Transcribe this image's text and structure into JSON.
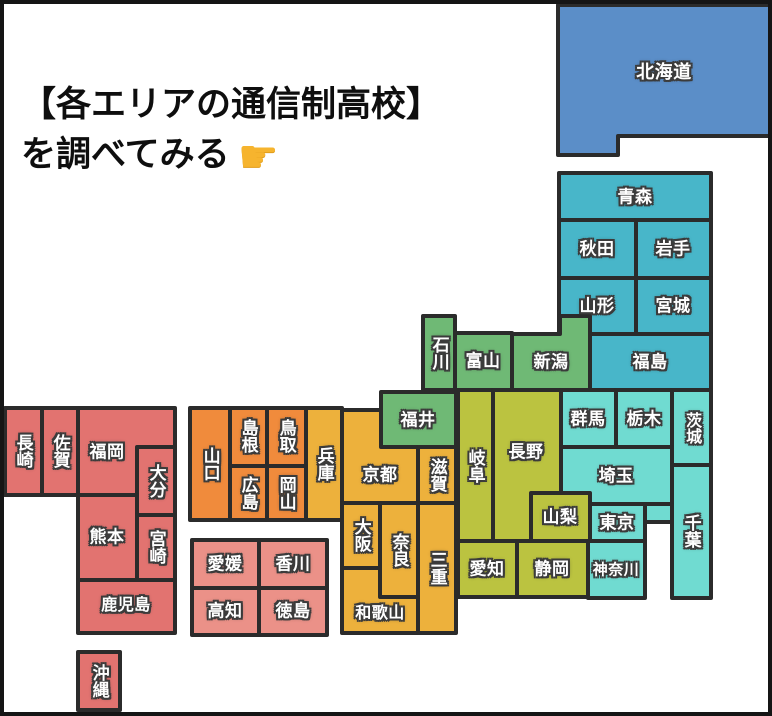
{
  "title": {
    "line1": "【各エリアの通信制高校】",
    "line2": "を調べてみる",
    "pointer_icon": {
      "name": "backhand-index-pointing-right",
      "glyph": "☛",
      "color": "#f6b42e"
    }
  },
  "map": {
    "border_color": "#2b2b2b",
    "region_colors": {
      "hokkaido": "#5b8ec8",
      "tohoku": "#48b6c9",
      "hokuriku": "#6fb975",
      "kanto": "#70dbd1",
      "chubu": "#bbc340",
      "kansai": "#edb13c",
      "chugoku": "#f08b3c",
      "shikoku": "#eb9188",
      "kyushu": "#e27370"
    },
    "regions": {
      "hokkaido": [
        "hokkaido"
      ],
      "tohoku": [
        "aomori",
        "akita",
        "iwate",
        "yamagata",
        "miyagi",
        "fukushima"
      ],
      "hokuriku": [
        "niigata",
        "toyama",
        "ishikawa",
        "fukui"
      ],
      "kanto": [
        "gunma",
        "tochigi",
        "ibaraki",
        "saitama",
        "chiba",
        "tokyo",
        "kanagawa"
      ],
      "chubu": [
        "nagano",
        "yamanashi",
        "gifu",
        "aichi",
        "shizuoka"
      ],
      "kansai": [
        "kyoto",
        "shiga",
        "hyogo",
        "osaka",
        "nara",
        "wakayama",
        "mie"
      ],
      "chugoku": [
        "yamaguchi",
        "shimane",
        "tottori",
        "hiroshima",
        "okayama"
      ],
      "shikoku": [
        "ehime",
        "kagawa",
        "kochi",
        "tokushima"
      ],
      "kyushu": [
        "fukuoka",
        "saga",
        "nagasaki",
        "oita",
        "kumamoto",
        "miyazaki",
        "kagoshima",
        "okinawa"
      ]
    },
    "prefectures": {
      "hokkaido": "北海道",
      "aomori": "青森",
      "akita": "秋田",
      "iwate": "岩手",
      "yamagata": "山形",
      "miyagi": "宮城",
      "fukushima": "福島",
      "niigata": "新潟",
      "toyama": "富山",
      "ishikawa": "石川",
      "fukui": "福井",
      "gunma": "群馬",
      "tochigi": "栃木",
      "ibaraki": "茨城",
      "saitama": "埼玉",
      "chiba": "千葉",
      "tokyo": "東京",
      "kanagawa": "神奈川",
      "nagano": "長野",
      "yamanashi": "山梨",
      "gifu": "岐阜",
      "aichi": "愛知",
      "shizuoka": "静岡",
      "kyoto": "京都",
      "shiga": "滋賀",
      "hyogo": "兵庫",
      "osaka": "大阪",
      "nara": "奈良",
      "wakayama": "和歌山",
      "mie": "三重",
      "yamaguchi": "山口",
      "shimane": "島根",
      "tottori": "鳥取",
      "hiroshima": "広島",
      "okayama": "岡山",
      "ehime": "愛媛",
      "kagawa": "香川",
      "kochi": "高知",
      "tokushima": "徳島",
      "fukuoka": "福岡",
      "saga": "佐賀",
      "nagasaki": "長崎",
      "oita": "大分",
      "kumamoto": "熊本",
      "miyazaki": "宮崎",
      "kagoshima": "鹿児島",
      "okinawa": "沖縄"
    }
  }
}
